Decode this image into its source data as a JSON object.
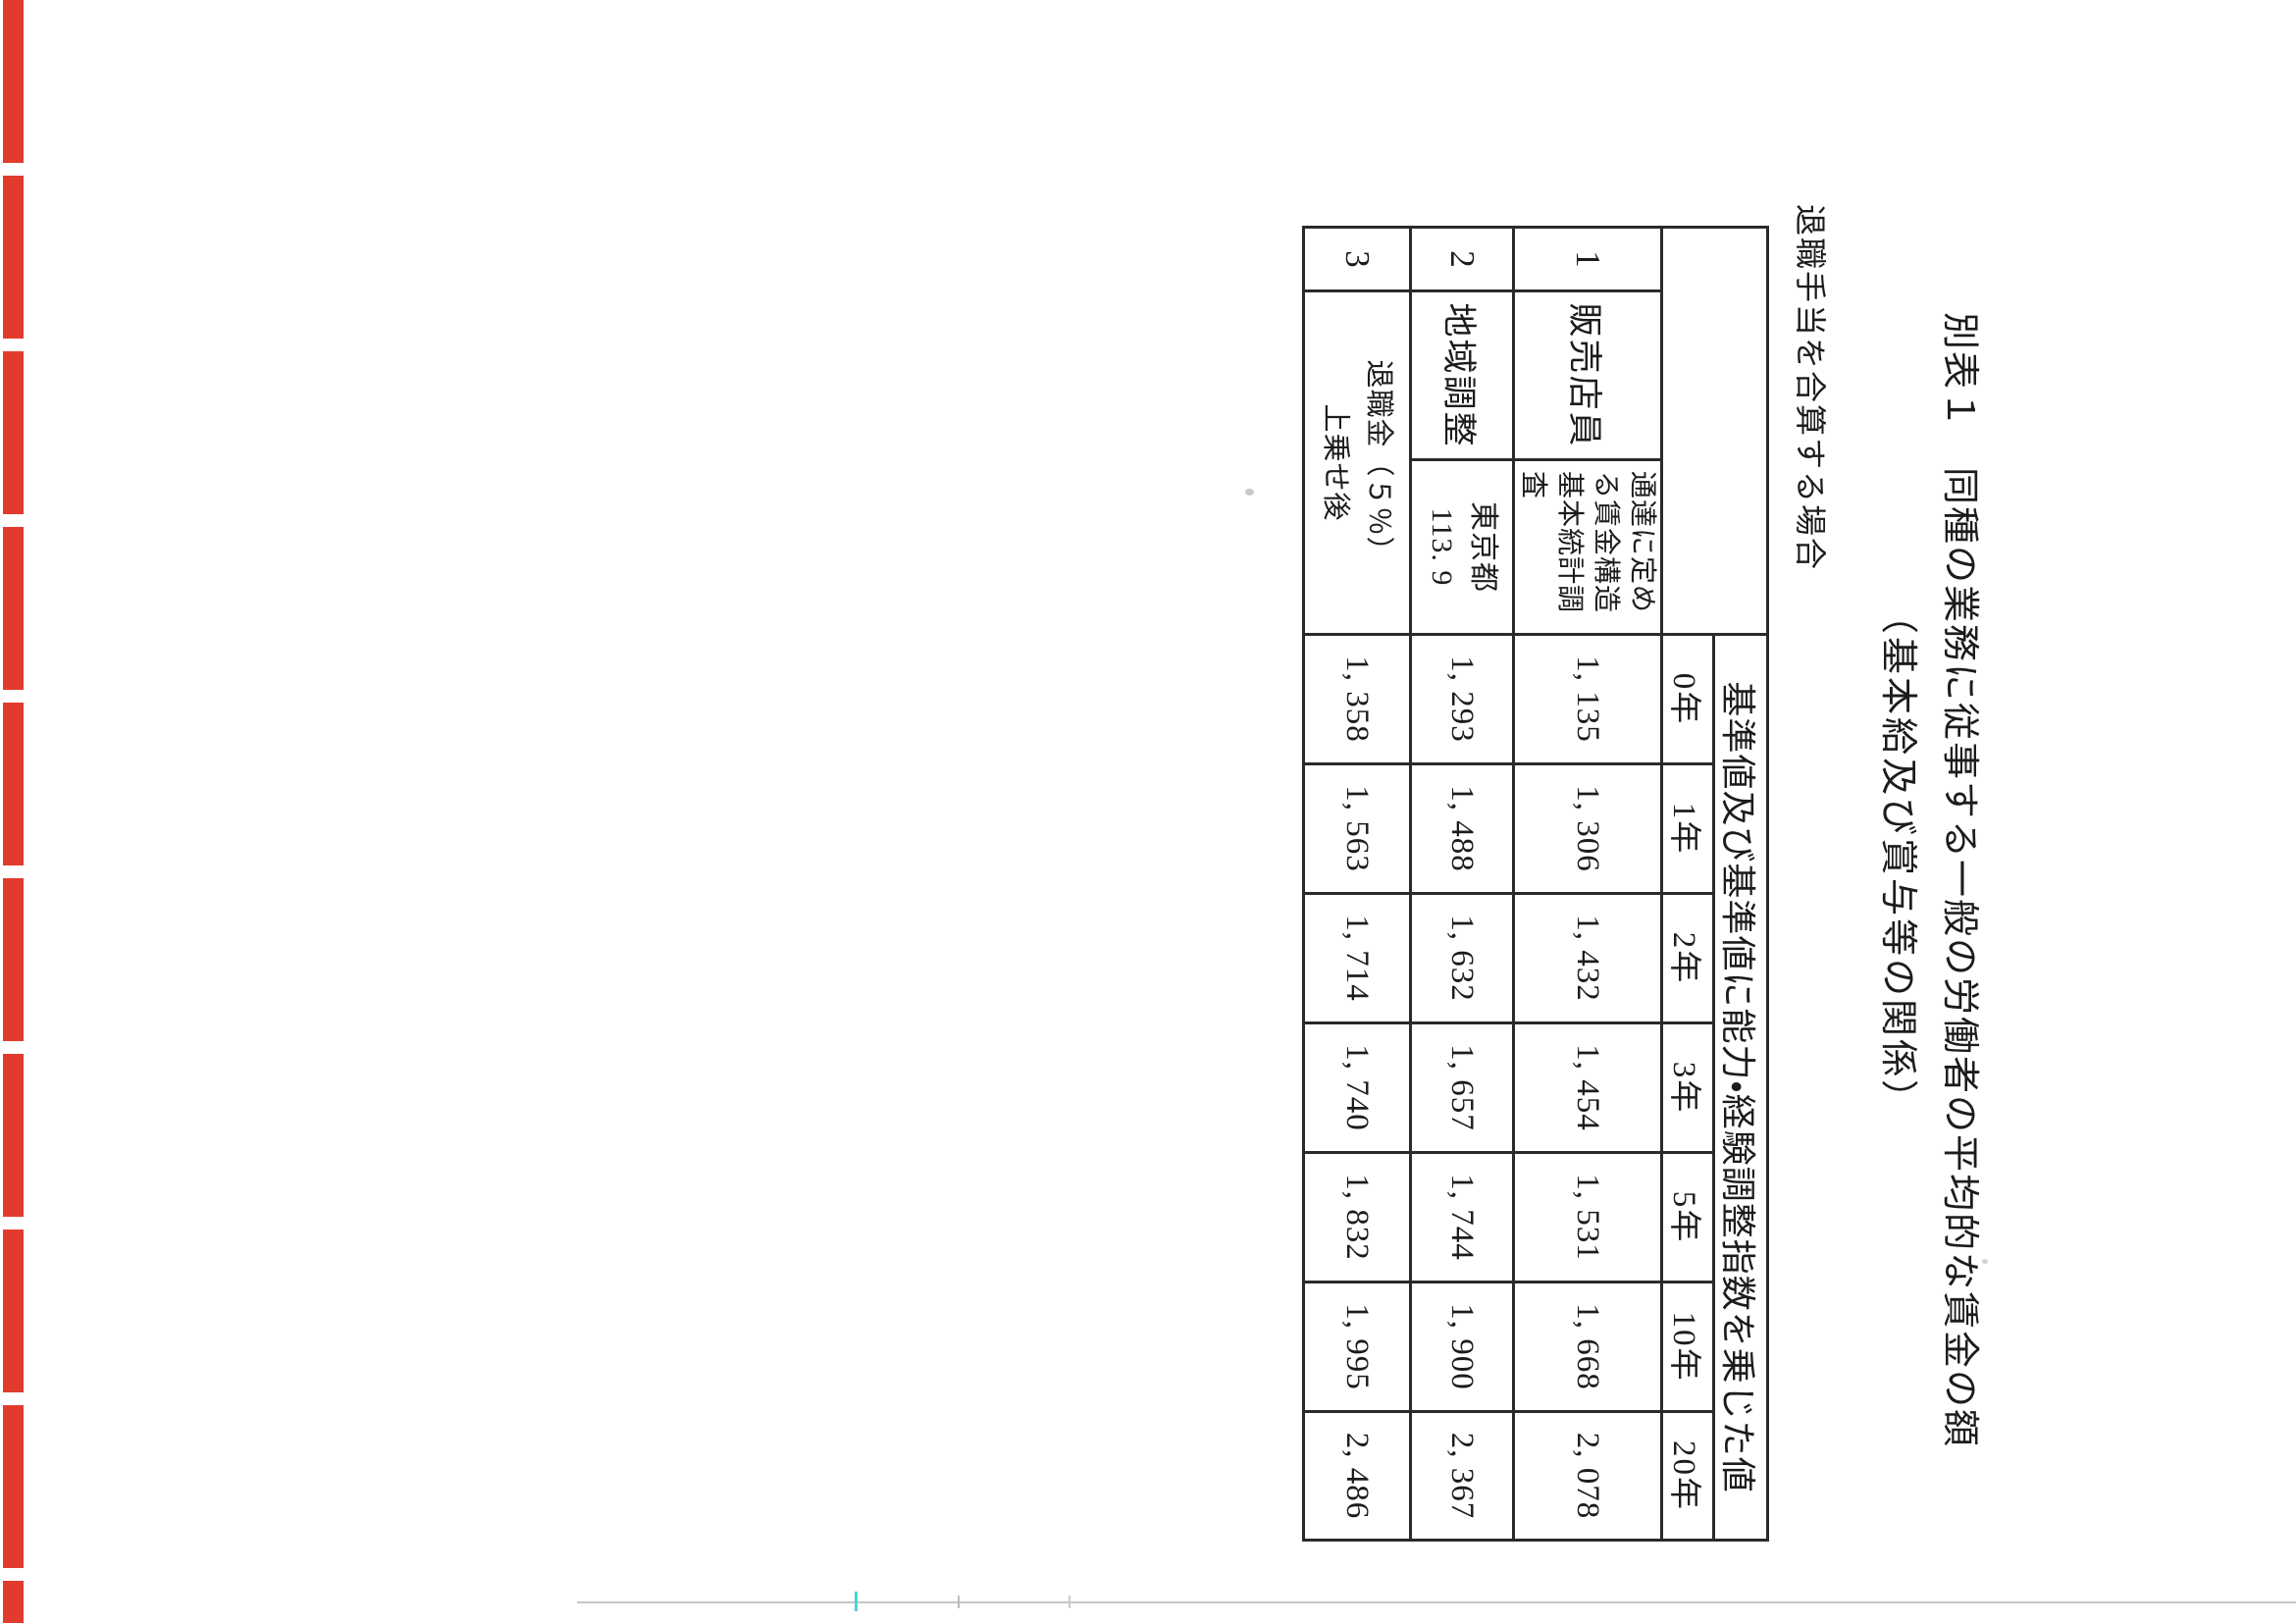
{
  "page": {
    "doc_label": "別表１",
    "title": "同種の業務に従事する一般の労働者の平均的な賃金の額",
    "subtitle": "（基本給及び賞与等の関係）",
    "note": "退職手当を合算する場合"
  },
  "table": {
    "value_header": "基準値及び基準値に能力・経験調整指数を乗じた値",
    "year_headers": [
      "0年",
      "1年",
      "2年",
      "3年",
      "5年",
      "10年",
      "20年"
    ],
    "rows": [
      {
        "no": "1",
        "label": "販売店員",
        "sub": "通達に定める賃金構造基本統計調査",
        "values": [
          "1, 135",
          "1, 306",
          "1, 432",
          "1, 454",
          "1, 531",
          "1, 668",
          "2, 078"
        ]
      },
      {
        "no": "2",
        "label": "地域調整",
        "sub_line1": "東京都",
        "sub_line2": "113. 9",
        "values": [
          "1, 293",
          "1, 488",
          "1, 632",
          "1, 657",
          "1, 744",
          "1, 900",
          "2, 367"
        ]
      },
      {
        "no": "3",
        "label_line1": "退職金（５％）",
        "label_line2": "上乗せ後",
        "highlighted": true,
        "values": [
          "1, 358",
          "1, 563",
          "1, 714",
          "1, 740",
          "1, 832",
          "1, 995",
          "2, 486"
        ]
      }
    ]
  },
  "artifact_colors": {
    "edge_strip_red": "#e23b2e",
    "bottom_line_gray": "#c6c6c6",
    "tick_cyan": "#46d5dc"
  }
}
